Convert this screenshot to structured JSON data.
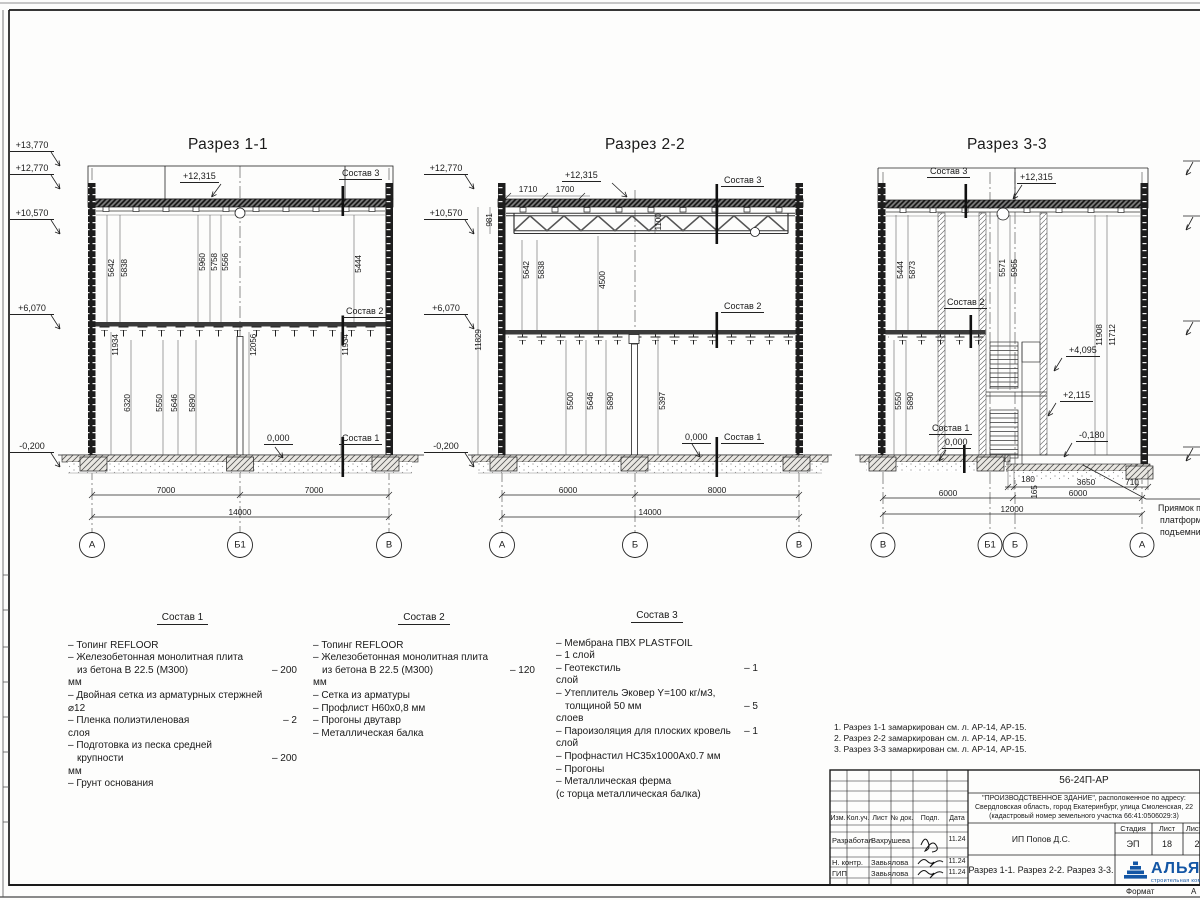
{
  "s1": {
    "title": "Разрез 1-1",
    "elevs": [
      "+13,770",
      "+12,770",
      "+10,570",
      "+6,070",
      "-0,200"
    ],
    "roof_mark": "+12,315",
    "c3": "Состав 3",
    "c2": "Состав 2",
    "c1": "Состав 1",
    "zero": "0,000",
    "du": [
      "5642",
      "5838",
      "5960",
      "5758",
      "5566",
      "5444"
    ],
    "dl": [
      "11934",
      "12056",
      "11934"
    ],
    "df": [
      "6320",
      "5550",
      "5646",
      "5890"
    ],
    "db": [
      "7000",
      "7000",
      "14000"
    ],
    "axes": [
      "А",
      "Б1",
      "В"
    ]
  },
  "s2": {
    "title": "Разрез 2-2",
    "elevs": [
      "+12,770",
      "+10,570",
      "+6,070",
      "-0,200"
    ],
    "top_dims": [
      "1710",
      "1700"
    ],
    "roof_mark": "+12,315",
    "c3": "Состав 3",
    "c2": "Состав 2",
    "c1": "Состав 1",
    "zero": "0,000",
    "truss_dims": [
      "981",
      "1100"
    ],
    "du": [
      "5642",
      "5838",
      "4500",
      "11829"
    ],
    "dl": [
      "5500",
      "5646",
      "5890",
      "5397"
    ],
    "db": [
      "6000",
      "8000",
      "14000"
    ],
    "axes": [
      "А",
      "Б",
      "В"
    ]
  },
  "s3": {
    "title": "Разрез 3-3",
    "roof_mark": "+12,315",
    "c3": "Состав 3",
    "c2": "Состав 2",
    "c1": "Состав 1",
    "zero": "0,000",
    "marks": [
      "+4,095",
      "+2,115",
      "-0,180"
    ],
    "du": [
      "5444",
      "5873",
      "5571",
      "5965",
      "11908",
      "11712"
    ],
    "dl": [
      "5550",
      "5890"
    ],
    "ds": [
      "180",
      "165",
      "3650",
      "710"
    ],
    "db": [
      "6000",
      "6000",
      "12000"
    ],
    "axes": [
      "В",
      "Б1",
      "Б",
      "А"
    ],
    "pit_note": [
      "Приямок п",
      "платформ",
      "подъемни"
    ]
  },
  "comp1": {
    "title": "Состав 1",
    "lines": [
      {
        "t": "– Топинг REFLOOR",
        "v": ""
      },
      {
        "t": "– Железобетонная  монолитная плита",
        "v": ""
      },
      {
        "t": "из бетона В 22.5 (М300)",
        "v": "– 200"
      },
      {
        "t": "мм",
        "v": ""
      },
      {
        "t": "– Двойная сетка из арматурных стержней",
        "v": ""
      },
      {
        "t": "⌀12",
        "v": ""
      },
      {
        "t": "– Пленка полиэтиленовая",
        "v": "–  2"
      },
      {
        "t": "слоя",
        "v": ""
      },
      {
        "t": "– Подготовка из песка средней",
        "v": ""
      },
      {
        "t": "крупности",
        "v": "– 200"
      },
      {
        "t": "мм",
        "v": ""
      },
      {
        "t": "– Грунт основания",
        "v": ""
      }
    ]
  },
  "comp2": {
    "title": "Состав 2",
    "lines": [
      {
        "t": "– Топинг REFLOOR",
        "v": ""
      },
      {
        "t": "– Железобетонная  монолитная плита",
        "v": ""
      },
      {
        "t": "из бетона В 22.5 (М300)",
        "v": "– 120"
      },
      {
        "t": "мм",
        "v": ""
      },
      {
        "t": "– Сетка из арматуры",
        "v": ""
      },
      {
        "t": "– Профлист Н60х0,8 мм",
        "v": ""
      },
      {
        "t": "– Прогоны двутавр",
        "v": ""
      },
      {
        "t": "– Металлическая балка",
        "v": ""
      }
    ]
  },
  "comp3": {
    "title": "Состав 3",
    "lines": [
      {
        "t": "– Мембрана ПВХ PLASTFOIL",
        "v": ""
      },
      {
        "t": "– 1 слой",
        "v": ""
      },
      {
        "t": "– Геотекстиль",
        "v": "– 1"
      },
      {
        "t": "слой",
        "v": ""
      },
      {
        "t": "– Утеплитель Эковер Y=100 кг/м3,",
        "v": ""
      },
      {
        "t": "толщиной 50 мм",
        "v": "– 5"
      },
      {
        "t": "слоев",
        "v": ""
      },
      {
        "t": "– Пароизоляция для плоских кровель",
        "v": "– 1"
      },
      {
        "t": "слой",
        "v": ""
      },
      {
        "t": "– Профнастил НС35х1000Ах0.7 мм",
        "v": ""
      },
      {
        "t": "– Прогоны",
        "v": ""
      },
      {
        "t": "– Металлическая ферма",
        "v": ""
      },
      {
        "t": "(с торца металлическая балка)",
        "v": ""
      }
    ]
  },
  "notes": [
    "1. Разрез 1-1 замаркирован см. л. АР-14, АР-15.",
    "2. Разрез 2-2 замаркирован см. л. АР-14, АР-15.",
    "3. Разрез 3-3 замаркирован см. л. АР-14, АР-15."
  ],
  "tb": {
    "doc": "56-24П-АР",
    "desc1": "\"ПРОИЗВОДСТВЕННОЕ ЗДАНИЕ\", расположенное по адресу:",
    "desc2": "Свердловская область, город Екатеринбург, улица Смоленская, 22",
    "desc3": "(кадастровый номер земельного участка 66:41:0506029:3)",
    "col_headers": [
      "Изм.",
      "Кол.уч.",
      "Лист",
      "№ док.",
      "Подп.",
      "Дата"
    ],
    "rows": [
      {
        "role": "Разработал",
        "name": "Вахрушева",
        "date": "11.24"
      },
      {
        "role": "Н. контр.",
        "name": "Завьялова",
        "date": "11.24"
      },
      {
        "role": "ГИП",
        "name": "Завьялова",
        "date": "11.24"
      }
    ],
    "client": "ИП Попов Д.С.",
    "stage_header": "Стадия",
    "sheet_header": "Лист",
    "sheets_header": "Листов",
    "stage": "ЭП",
    "sheet": "18",
    "sheets": "2",
    "drawing_title": "Разрез 1-1. Разрез 2-2. Разрез 3-3.",
    "logo_text": "АЛЬЯНС",
    "logo_sub": "строительная компания",
    "format_label": "Формат",
    "format_value": "А"
  }
}
